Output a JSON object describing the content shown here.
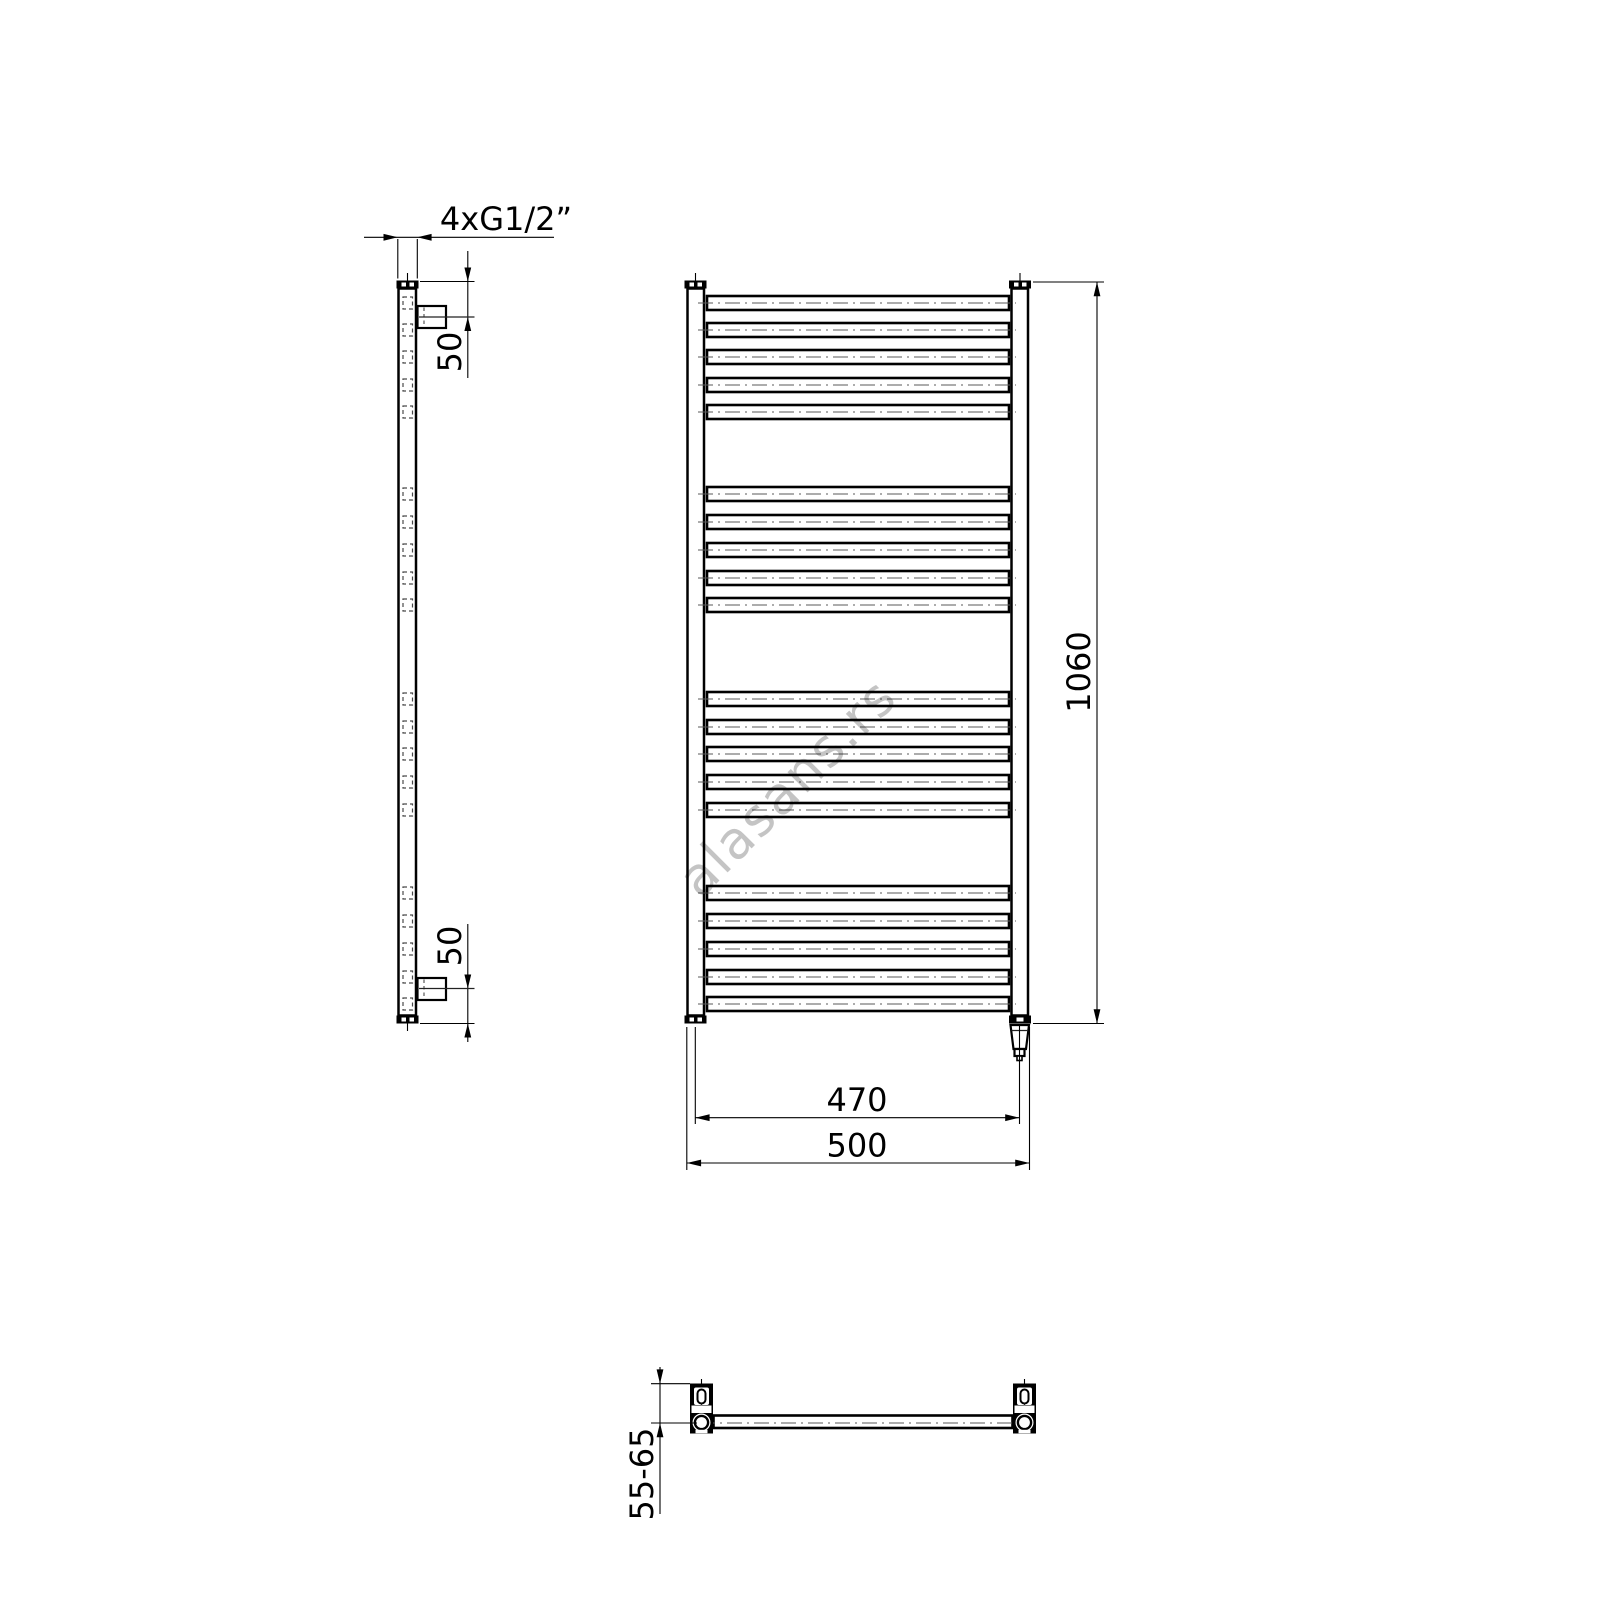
{
  "watermark": {
    "text": "alasans.rs",
    "color": "#c4c4c4"
  },
  "dimensions": {
    "connection_thread": "4xG1/2”",
    "top_connection_offset": "50",
    "bottom_connection_offset": "50",
    "overall_height": "1060",
    "connection_spacing": "470",
    "overall_width": "500",
    "wall_clearance": "55-65"
  },
  "figure": {
    "stroke_color": "#000000",
    "centerline_color": "#5a5a5a",
    "tube_centers_y": [
      303,
      330,
      357,
      385,
      412,
      494,
      522,
      550,
      578,
      605,
      699,
      727,
      754,
      782,
      810,
      893,
      921,
      949,
      977,
      1004
    ],
    "front": {
      "tube_left": 707,
      "tube_width": 302,
      "tube_height": 14,
      "axis_x1": 698,
      "axis_x2": 1016
    },
    "side": {
      "port_x": 403,
      "port_width": 9.5,
      "port_height": 12
    }
  }
}
